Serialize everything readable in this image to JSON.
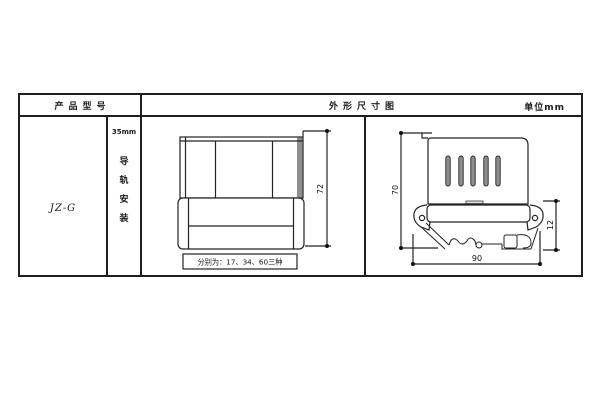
{
  "header": {
    "product_model_label": "产品型号",
    "drawing_title": "外形尺寸图",
    "unit_label": "单位mm"
  },
  "model_cell": {
    "model": "JZ-G"
  },
  "mounting_cell": {
    "rail_width": "35mm",
    "chars": [
      "导",
      "轨",
      "安",
      "装"
    ]
  },
  "front_view": {
    "height_dim": "72",
    "width_note": "分别为：17、34、60三种"
  },
  "side_view": {
    "height_dim": "70",
    "clip_dim": "12",
    "width_dim": "90"
  },
  "colors": {
    "line": "#232323",
    "shade": "#8f8f8f"
  }
}
